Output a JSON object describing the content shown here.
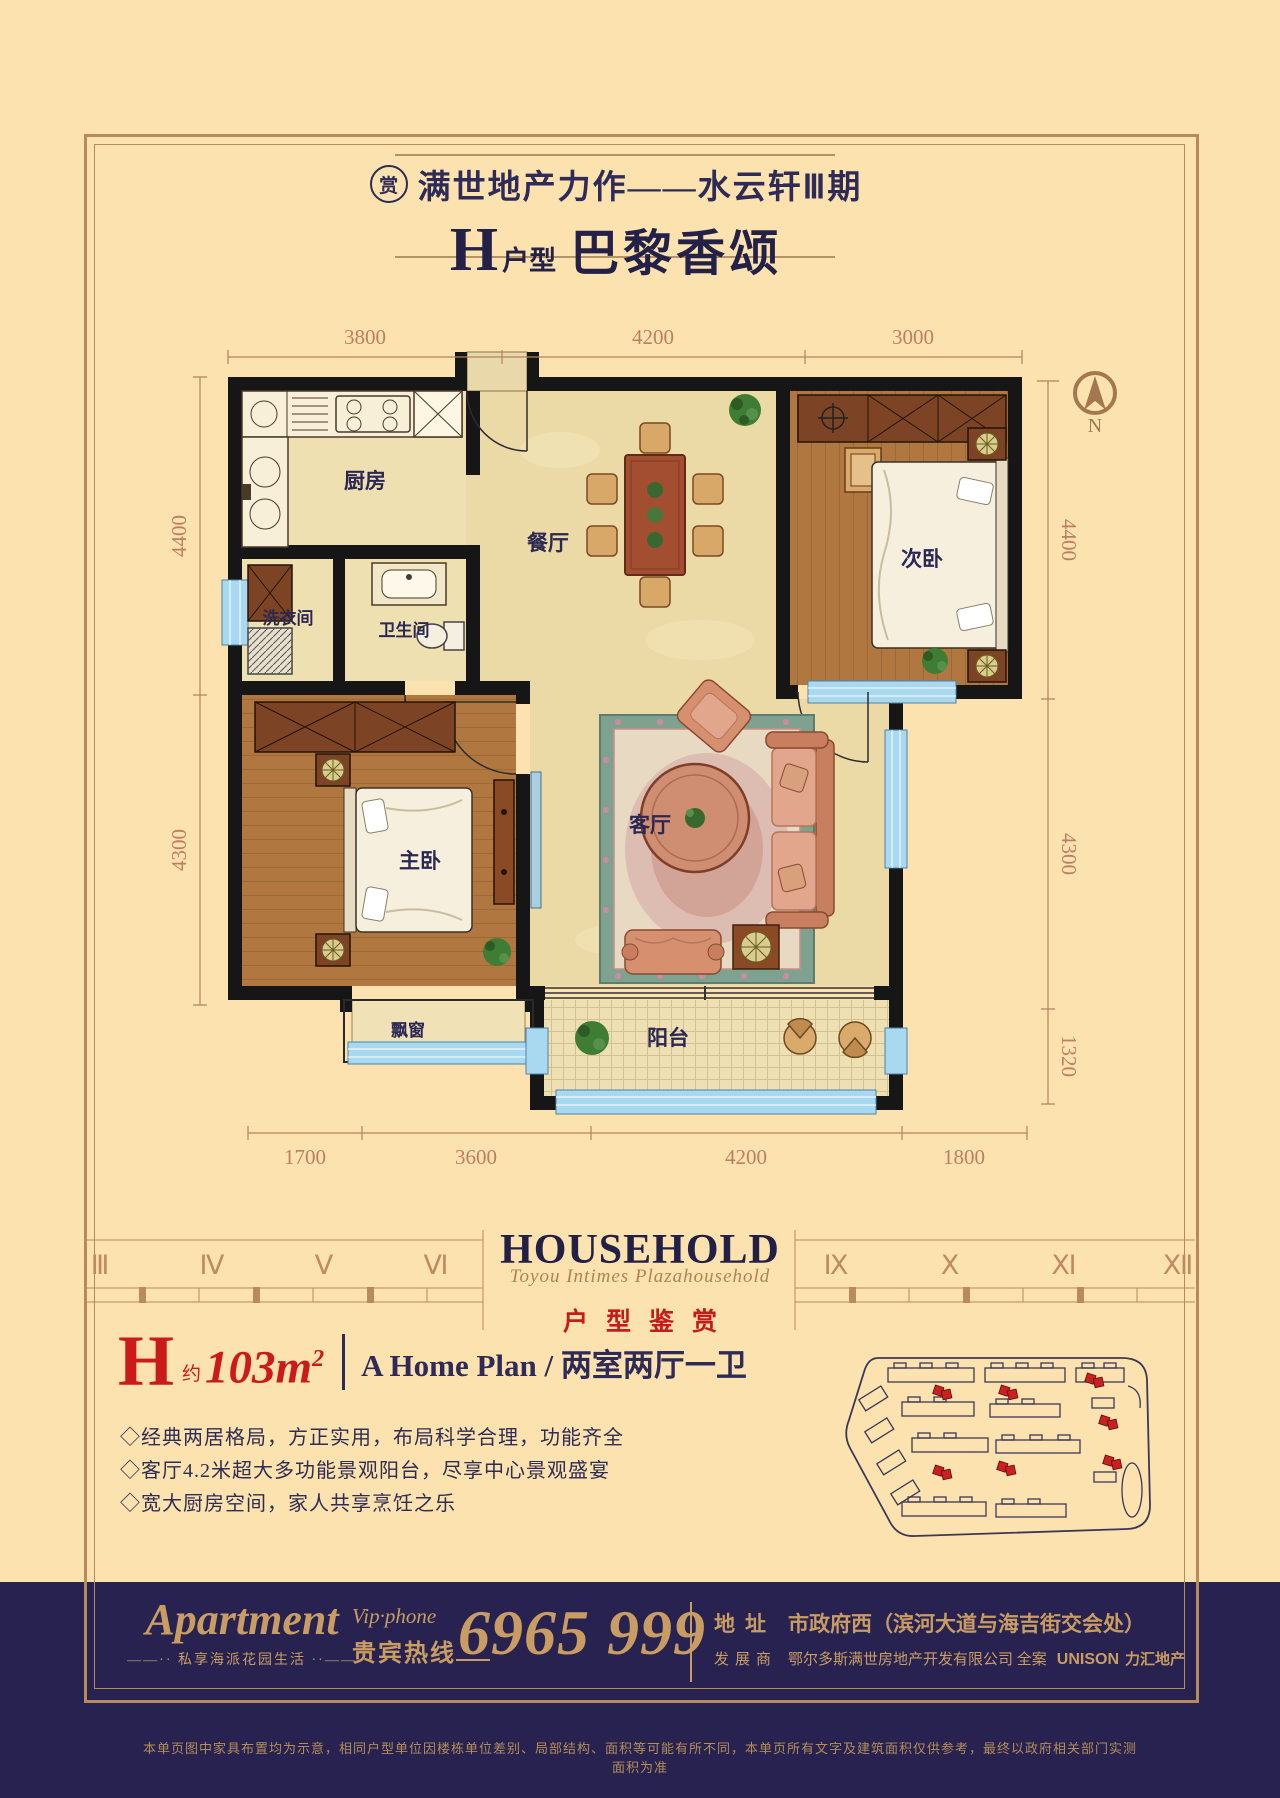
{
  "header": {
    "badge": "赏",
    "line1": "满世地产力作——水云轩Ⅲ期",
    "type_letter": "H",
    "type_word": "户型",
    "name": "巴黎香颂"
  },
  "plan": {
    "rooms": {
      "kitchen": "厨房",
      "dining": "餐厅",
      "bedroom2": "次卧",
      "laundry": "洗衣间",
      "bath": "卫生间",
      "master": "主卧",
      "living": "客厅",
      "bay": "飘窗",
      "balcony": "阳台"
    },
    "dims": {
      "top": [
        "3800",
        "4200",
        "3000"
      ],
      "left": [
        "4400",
        "4300"
      ],
      "right": [
        "4400",
        "4300",
        "1320"
      ],
      "bottom": [
        "1700",
        "3600",
        "4200",
        "1800"
      ]
    },
    "compass_n": "N"
  },
  "brand": {
    "household": "HOUSEHOLD",
    "script": "Toyou Intimes Plazahousehold",
    "appreciation": "户型鉴赏",
    "ruler_left": [
      "Ⅲ",
      "Ⅳ",
      "Ⅴ",
      "Ⅵ"
    ],
    "ruler_right": [
      "Ⅸ",
      "Ⅹ",
      "Ⅺ",
      "Ⅻ"
    ]
  },
  "spec": {
    "h": "H",
    "approx": "约",
    "area": "103m",
    "area_exp": "2",
    "subtitle": "A Home Plan / 两室两厅一卫",
    "bullets": [
      "◇经典两居格局，方正实用，布局科学合理，功能齐全",
      "◇客厅4.2米超大多功能景观阳台，尽享中心景观盛宴",
      "◇宽大厨房空间，家人共享烹饪之乐"
    ]
  },
  "footer": {
    "apartment": "Apartment",
    "tagline": "——·· 私享海派花园生活 ··——",
    "vip_label": "Vip·phone",
    "hotline_label": "贵宾热线",
    "phone": "6965 999",
    "addr_label": "地址",
    "addr_value": "市政府西（滨河大道与海吉街交会处）",
    "dev_label": "发展商",
    "dev_value": "鄂尔多斯满世房地产开发有限公司  全案",
    "brand_latin": "UNISON",
    "brand_cn": "力汇地产",
    "disclaimer": "本单页图中家具布置均为示意，相同户型单位因楼栋单位差别、局部结构、面积等可能有所不同，本单页所有文字及建筑面积仅供参考，最终以政府相关部门实测面积为准"
  },
  "colors": {
    "accent_red": "#c41b1b",
    "navy": "#2e2b58",
    "gold": "#b8895a",
    "footer_bg": "#272250",
    "background": "#fbe2af"
  }
}
